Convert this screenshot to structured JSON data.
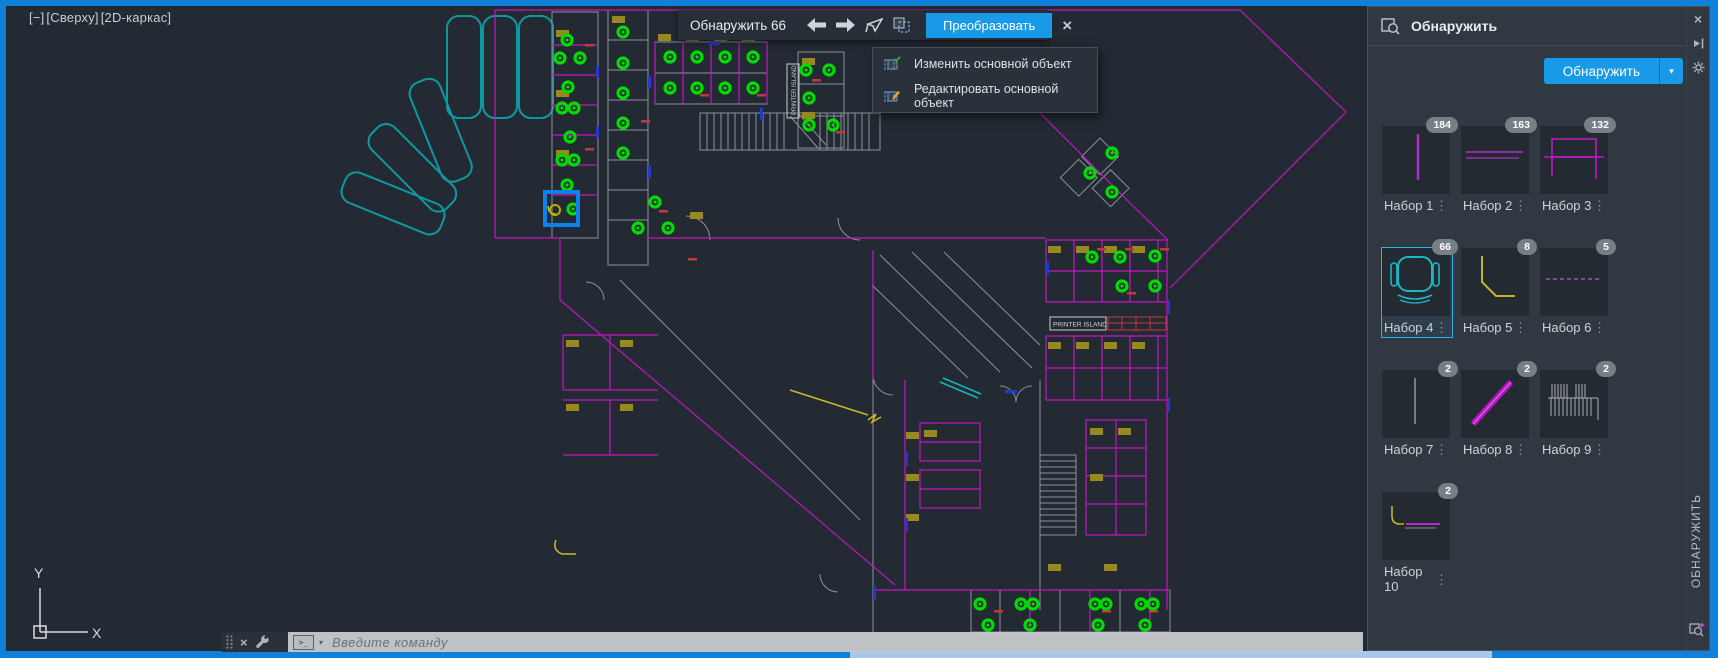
{
  "viewport": {
    "minimized": "[−]",
    "view": "[Сверху]",
    "style": "[2D-каркас]"
  },
  "toolbar": {
    "title": "Обнаружить 66",
    "convert_label": "Преобразовать"
  },
  "context_menu": {
    "items": [
      {
        "label": "Изменить основной объект"
      },
      {
        "label": "Редактировать основной объект"
      }
    ]
  },
  "panel": {
    "title": "Обнаружить",
    "action_label": "Обнаружить",
    "vertical_tab": "ОБНАРУЖИТЬ",
    "sets": [
      {
        "label": "Набор 1",
        "count": "184",
        "selected": false
      },
      {
        "label": "Набор 2",
        "count": "163",
        "selected": false
      },
      {
        "label": "Набор 3",
        "count": "132",
        "selected": false
      },
      {
        "label": "Набор 4",
        "count": "66",
        "selected": true
      },
      {
        "label": "Набор 5",
        "count": "8",
        "selected": false
      },
      {
        "label": "Набор 6",
        "count": "5",
        "selected": false
      },
      {
        "label": "Набор 7",
        "count": "2",
        "selected": false
      },
      {
        "label": "Набор 8",
        "count": "2",
        "selected": false
      },
      {
        "label": "Набор 9",
        "count": "2",
        "selected": false
      },
      {
        "label": "Набор 10",
        "count": "2",
        "selected": false
      }
    ]
  },
  "command_line": {
    "placeholder": "Введите  команду"
  },
  "drawing": {
    "printer_island_label": "PRINTER ISLAND",
    "ucs": {
      "x_label": "X",
      "y_label": "Y"
    },
    "chairs": [
      [
        567,
        40
      ],
      [
        560,
        58
      ],
      [
        580,
        58
      ],
      [
        568,
        87
      ],
      [
        562,
        108
      ],
      [
        574,
        108
      ],
      [
        570,
        137
      ],
      [
        562,
        160
      ],
      [
        574,
        160
      ],
      [
        567,
        185
      ],
      [
        573,
        209
      ],
      [
        623,
        32
      ],
      [
        623,
        63
      ],
      [
        623,
        93
      ],
      [
        623,
        123
      ],
      [
        623,
        153
      ],
      [
        655,
        202
      ],
      [
        638,
        228
      ],
      [
        668,
        228
      ],
      [
        670,
        57
      ],
      [
        697,
        57
      ],
      [
        725,
        57
      ],
      [
        753,
        57
      ],
      [
        670,
        88
      ],
      [
        697,
        88
      ],
      [
        725,
        88
      ],
      [
        753,
        88
      ],
      [
        806,
        70
      ],
      [
        829,
        70
      ],
      [
        809,
        98
      ],
      [
        809,
        125
      ],
      [
        833,
        125
      ],
      [
        1112,
        153
      ],
      [
        1090,
        173
      ],
      [
        1112,
        192
      ],
      [
        1092,
        257
      ],
      [
        1120,
        257
      ],
      [
        1155,
        256
      ],
      [
        1122,
        286
      ],
      [
        1155,
        286
      ],
      [
        980,
        604
      ],
      [
        1021,
        604
      ],
      [
        1033,
        604
      ],
      [
        1095,
        604
      ],
      [
        1106,
        604
      ],
      [
        1141,
        604
      ],
      [
        1153,
        604
      ],
      [
        988,
        625
      ],
      [
        1030,
        625
      ],
      [
        1098,
        625
      ],
      [
        1145,
        625
      ]
    ]
  },
  "icons": {
    "close": "×",
    "dropdown": "▾",
    "menu_dots": "⋮"
  },
  "colors": {
    "window_border": "#1080d8",
    "accent_blue": "#189ae6",
    "selection_cyan": "#2cb2e4",
    "detected_green": "#00dc00",
    "wall_magenta": "#c018c0",
    "canopy_teal": "#0f98a0"
  }
}
